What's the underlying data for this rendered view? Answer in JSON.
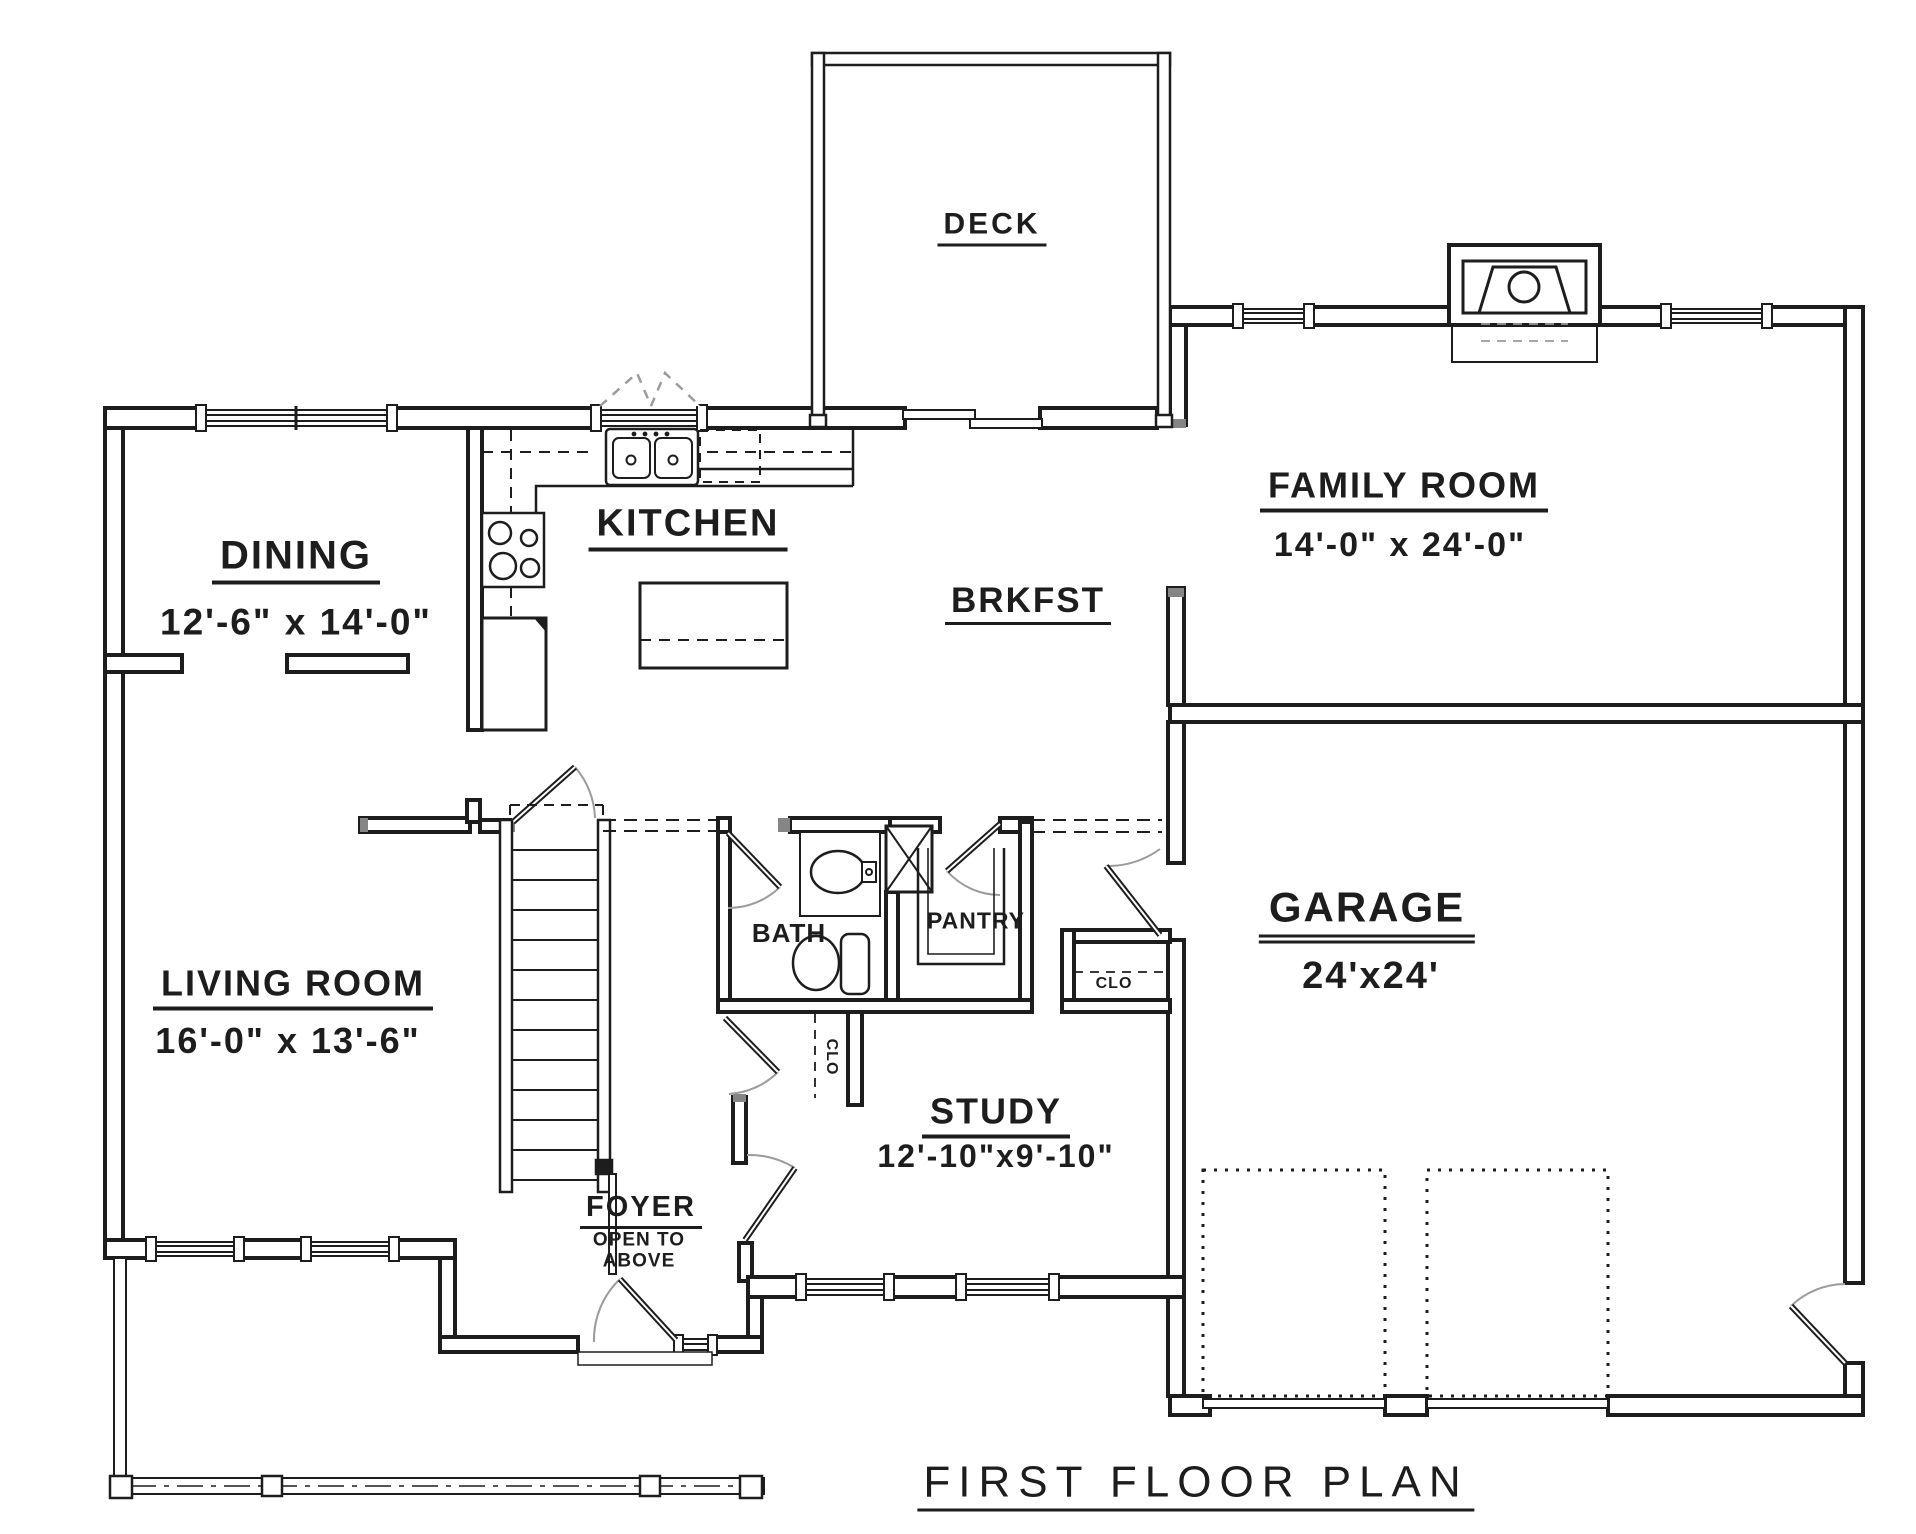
{
  "plan": {
    "title": "FIRST FLOOR PLAN",
    "deck": {
      "name": "DECK"
    },
    "dining": {
      "name": "DINING",
      "dims": "12'-6\" x 14'-0\""
    },
    "kitchen": {
      "name": "KITCHEN"
    },
    "brkfst": {
      "name": "BRKFST"
    },
    "family": {
      "name": "FAMILY ROOM",
      "dims": "14'-0\" x 24'-0\""
    },
    "living": {
      "name": "LIVING ROOM",
      "dims": "16'-0\" x 13'-6\""
    },
    "bath": {
      "name": "BATH"
    },
    "pantry": {
      "name": "PANTRY"
    },
    "closet_hall": {
      "name": "CLO"
    },
    "closet_foyer": {
      "name": "CLO"
    },
    "study": {
      "name": "STUDY",
      "dims": "12'-10\"x9'-10\""
    },
    "garage": {
      "name": "GARAGE",
      "dims": "24'x24'"
    },
    "foyer": {
      "name": "FOYER",
      "note_line1": "OPEN TO",
      "note_line2": "ABOVE"
    }
  },
  "colors": {
    "ink": "#1d1d1d",
    "arc": "#9b9b9b",
    "paper": "#ffffff"
  }
}
